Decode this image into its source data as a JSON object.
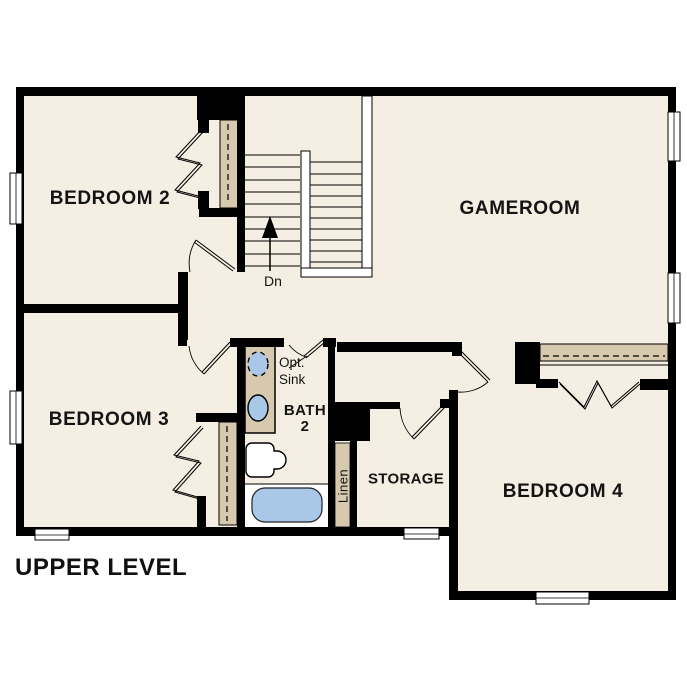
{
  "plan": {
    "title": "UPPER LEVEL",
    "rooms": {
      "bedroom2": "BEDROOM 2",
      "gameroom": "GAMEROOM",
      "bedroom3": "BEDROOM 3",
      "bedroom4": "BEDROOM 4",
      "bath_line1": "BATH",
      "bath_line2": "2",
      "storage": "STORAGE"
    },
    "annotations": {
      "stairs_direction": "Dn",
      "optional_sink_line1": "Opt.",
      "optional_sink_line2": "Sink",
      "linen_closet": "Linen"
    },
    "colors": {
      "background": "#FFFFFF",
      "floor": "#F5EEE2",
      "wall": "#000000",
      "casework": "#D6C9AE",
      "fixture_blue": "#A9C7E7"
    }
  }
}
